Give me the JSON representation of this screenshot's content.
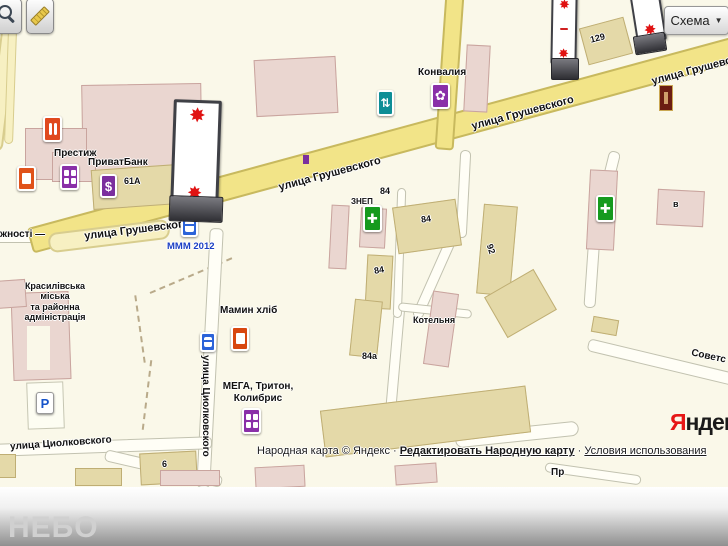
{
  "controls": {
    "schema_button": {
      "label": "Схема",
      "arrow": "▼"
    },
    "icons": {
      "zoom_tool": "magnifier-icon",
      "measure_tool": "ruler-icon"
    }
  },
  "streets": {
    "grushevskogo": "улица Грушевского",
    "grushevskogo_partial": "жності —",
    "tsiolkovskogo": "улица Циолковского",
    "sovetskaya_partial": "Советс",
    "pr_partial": "Пр"
  },
  "places": {
    "prestizh": "Престиж",
    "privatbank": "ПриватБанк",
    "mmm2012": "МММ 2012",
    "konvaliya": "Конвалия",
    "znep": "ЗНЕП",
    "mamyn_khlib": "Мамин хліб",
    "mega": "МЕГА, Тритон,\nКолибрис",
    "kotelnya": "Котельня",
    "admin": "Красилівська\nміська\nта районна\nадміністрація"
  },
  "buildings": {
    "b61a": "61А",
    "b129": "129",
    "b84": "84",
    "b84a": "84а",
    "b92": "92",
    "b6": "6",
    "bv": "в"
  },
  "poi_glyphs": {
    "parking": "P",
    "bank_dollar": "$",
    "pharmacy_cross": "✚",
    "crossing_arrows": "⇅",
    "flower": "✿",
    "splash": "✸"
  },
  "attribution": {
    "prefix": "Народная карта © Яндекс · ",
    "edit_link": "Редактировать Народную карту",
    "separator": " · ",
    "terms_link": "Условия использования"
  },
  "logo": {
    "first": "Я",
    "rest": "ндекс"
  },
  "footer": {
    "brand": "НЕБО"
  }
}
